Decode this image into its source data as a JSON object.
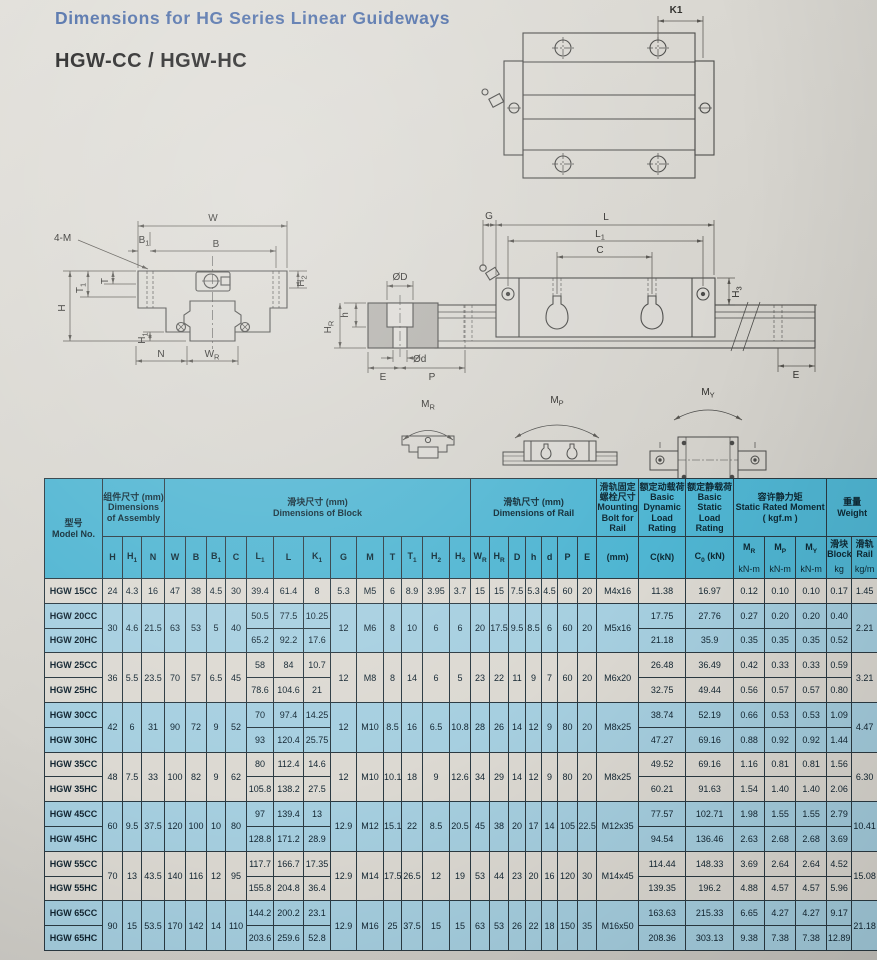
{
  "page": {
    "title": "Dimensions for HG Series Linear Guideways",
    "subtitle": "HGW-CC / HGW-HC"
  },
  "drawings": {
    "k1": "K1",
    "w": "W",
    "b1": "B~1~",
    "b": "B",
    "four_m": "4-M",
    "t": "T",
    "t1": "T~1~",
    "h": "H",
    "h2": "H~2~",
    "h1": "H~1~",
    "n": "N",
    "wr": "W~R~",
    "g": "G",
    "l": "L",
    "l1": "L~1~",
    "c": "C",
    "h3": "H~3~",
    "od": "ØD",
    "od_small": "Ød",
    "e_left": "E",
    "p": "P",
    "e_right": "E",
    "hr": "H~R~",
    "h_small": "h",
    "mr": "M~R~",
    "mp": "M~P~",
    "my": "M~Y~"
  },
  "table": {
    "header": {
      "model": {
        "zh": "型号",
        "en": "Model No."
      },
      "groups": [
        {
          "zh": "组件尺寸 (mm)",
          "en": "Dimensions of Assembly",
          "span": 3
        },
        {
          "zh": "滑块尺寸 (mm)",
          "en": "Dimensions of Block",
          "span": 13
        },
        {
          "zh": "滑轨尺寸 (mm)",
          "en": "Dimensions of Rail",
          "span": 7
        },
        {
          "zh": "滑轨固定螺栓尺寸",
          "en": "Mounting Bolt for Rail",
          "span": 1
        },
        {
          "zh": "额定动载荷",
          "en": "Basic Dynamic Load Rating",
          "span": 1
        },
        {
          "zh": "额定静载荷",
          "en": "Basic Static Load Rating",
          "span": 1
        },
        {
          "zh": "容许静力矩",
          "en": "Static Rated Moment ( kgf.m )",
          "span": 3
        },
        {
          "zh": "重量",
          "en": "Weight",
          "span": 2
        }
      ],
      "columns": [
        {
          "key": "H",
          "label": "H"
        },
        {
          "key": "H1",
          "label": "H~1~"
        },
        {
          "key": "N",
          "label": "N"
        },
        {
          "key": "W",
          "label": "W"
        },
        {
          "key": "B",
          "label": "B"
        },
        {
          "key": "B1",
          "label": "B~1~"
        },
        {
          "key": "C",
          "label": "C"
        },
        {
          "key": "L1",
          "label": "L~1~"
        },
        {
          "key": "L",
          "label": "L"
        },
        {
          "key": "K1",
          "label": "K~1~"
        },
        {
          "key": "G",
          "label": "G"
        },
        {
          "key": "M",
          "label": "M"
        },
        {
          "key": "T",
          "label": "T"
        },
        {
          "key": "T1",
          "label": "T~1~"
        },
        {
          "key": "H2",
          "label": "H~2~"
        },
        {
          "key": "H3",
          "label": "H~3~"
        },
        {
          "key": "WR",
          "label": "W~R~"
        },
        {
          "key": "HR",
          "label": "H~R~"
        },
        {
          "key": "D",
          "label": "D"
        },
        {
          "key": "h",
          "label": "h"
        },
        {
          "key": "d",
          "label": "d"
        },
        {
          "key": "P",
          "label": "P"
        },
        {
          "key": "E",
          "label": "E"
        },
        {
          "key": "bolt",
          "label": "(mm)"
        },
        {
          "key": "Cdyn",
          "label": "C(kN)"
        },
        {
          "key": "C0",
          "label": "C~0~ (kN)"
        },
        {
          "key": "MR",
          "label": "M~R~",
          "unit": "kN-m"
        },
        {
          "key": "MP",
          "label": "M~P~",
          "unit": "kN-m"
        },
        {
          "key": "MY",
          "label": "M~Y~",
          "unit": "kN-m"
        },
        {
          "key": "wblk",
          "label": "滑块 Block",
          "unit": "kg"
        },
        {
          "key": "wrail",
          "label": "滑轨 Rail",
          "unit": "kg/m"
        }
      ]
    },
    "groups": [
      {
        "tone": "light",
        "models": [
          "HGW 15CC"
        ],
        "shared": {
          "H": "24",
          "H1": "4.3",
          "N": "16",
          "W": "47",
          "B": "38",
          "B1": "4.5",
          "C": "30",
          "G": "5.3",
          "M": "M5",
          "T": "6",
          "T1": "8.9",
          "H2": "3.95",
          "H3": "3.7",
          "WR": "15",
          "HR": "15",
          "D": "7.5",
          "h": "5.3",
          "d": "4.5",
          "P": "60",
          "E": "20",
          "bolt": "M4x16",
          "wrail": "1.45"
        },
        "per": [
          {
            "L1": "39.4",
            "L": "61.4",
            "K1": "8",
            "Cdyn": "11.38",
            "C0": "16.97",
            "MR": "0.12",
            "MP": "0.10",
            "MY": "0.10",
            "wblk": "0.17"
          }
        ]
      },
      {
        "tone": "blue",
        "models": [
          "HGW 20CC",
          "HGW 20HC"
        ],
        "shared": {
          "H": "30",
          "H1": "4.6",
          "N": "21.5",
          "W": "63",
          "B": "53",
          "B1": "5",
          "C": "40",
          "G": "12",
          "M": "M6",
          "T": "8",
          "T1": "10",
          "H2": "6",
          "H3": "6",
          "WR": "20",
          "HR": "17.5",
          "D": "9.5",
          "h": "8.5",
          "d": "6",
          "P": "60",
          "E": "20",
          "bolt": "M5x16",
          "wrail": "2.21"
        },
        "per": [
          {
            "L1": "50.5",
            "L": "77.5",
            "K1": "10.25",
            "Cdyn": "17.75",
            "C0": "27.76",
            "MR": "0.27",
            "MP": "0.20",
            "MY": "0.20",
            "wblk": "0.40"
          },
          {
            "L1": "65.2",
            "L": "92.2",
            "K1": "17.6",
            "Cdyn": "21.18",
            "C0": "35.9",
            "MR": "0.35",
            "MP": "0.35",
            "MY": "0.35",
            "wblk": "0.52"
          }
        ]
      },
      {
        "tone": "light",
        "models": [
          "HGW 25CC",
          "HGW 25HC"
        ],
        "shared": {
          "H": "36",
          "H1": "5.5",
          "N": "23.5",
          "W": "70",
          "B": "57",
          "B1": "6.5",
          "C": "45",
          "G": "12",
          "M": "M8",
          "T": "8",
          "T1": "14",
          "H2": "6",
          "H3": "5",
          "WR": "23",
          "HR": "22",
          "D": "11",
          "h": "9",
          "d": "7",
          "P": "60",
          "E": "20",
          "bolt": "M6x20",
          "wrail": "3.21"
        },
        "per": [
          {
            "L1": "58",
            "L": "84",
            "K1": "10.7",
            "Cdyn": "26.48",
            "C0": "36.49",
            "MR": "0.42",
            "MP": "0.33",
            "MY": "0.33",
            "wblk": "0.59"
          },
          {
            "L1": "78.6",
            "L": "104.6",
            "K1": "21",
            "Cdyn": "32.75",
            "C0": "49.44",
            "MR": "0.56",
            "MP": "0.57",
            "MY": "0.57",
            "wblk": "0.80"
          }
        ]
      },
      {
        "tone": "blue",
        "models": [
          "HGW 30CC",
          "HGW 30HC"
        ],
        "shared": {
          "H": "42",
          "H1": "6",
          "N": "31",
          "W": "90",
          "B": "72",
          "B1": "9",
          "C": "52",
          "G": "12",
          "M": "M10",
          "T": "8.5",
          "T1": "16",
          "H2": "6.5",
          "H3": "10.8",
          "WR": "28",
          "HR": "26",
          "D": "14",
          "h": "12",
          "d": "9",
          "P": "80",
          "E": "20",
          "bolt": "M8x25",
          "wrail": "4.47"
        },
        "per": [
          {
            "L1": "70",
            "L": "97.4",
            "K1": "14.25",
            "Cdyn": "38.74",
            "C0": "52.19",
            "MR": "0.66",
            "MP": "0.53",
            "MY": "0.53",
            "wblk": "1.09"
          },
          {
            "L1": "93",
            "L": "120.4",
            "K1": "25.75",
            "Cdyn": "47.27",
            "C0": "69.16",
            "MR": "0.88",
            "MP": "0.92",
            "MY": "0.92",
            "wblk": "1.44"
          }
        ]
      },
      {
        "tone": "light",
        "models": [
          "HGW 35CC",
          "HGW 35HC"
        ],
        "shared": {
          "H": "48",
          "H1": "7.5",
          "N": "33",
          "W": "100",
          "B": "82",
          "B1": "9",
          "C": "62",
          "G": "12",
          "M": "M10",
          "T": "10.1",
          "T1": "18",
          "H2": "9",
          "H3": "12.6",
          "WR": "34",
          "HR": "29",
          "D": "14",
          "h": "12",
          "d": "9",
          "P": "80",
          "E": "20",
          "bolt": "M8x25",
          "wrail": "6.30"
        },
        "per": [
          {
            "L1": "80",
            "L": "112.4",
            "K1": "14.6",
            "Cdyn": "49.52",
            "C0": "69.16",
            "MR": "1.16",
            "MP": "0.81",
            "MY": "0.81",
            "wblk": "1.56"
          },
          {
            "L1": "105.8",
            "L": "138.2",
            "K1": "27.5",
            "Cdyn": "60.21",
            "C0": "91.63",
            "MR": "1.54",
            "MP": "1.40",
            "MY": "1.40",
            "wblk": "2.06"
          }
        ]
      },
      {
        "tone": "blue",
        "models": [
          "HGW 45CC",
          "HGW 45HC"
        ],
        "shared": {
          "H": "60",
          "H1": "9.5",
          "N": "37.5",
          "W": "120",
          "B": "100",
          "B1": "10",
          "C": "80",
          "G": "12.9",
          "M": "M12",
          "T": "15.1",
          "T1": "22",
          "H2": "8.5",
          "H3": "20.5",
          "WR": "45",
          "HR": "38",
          "D": "20",
          "h": "17",
          "d": "14",
          "P": "105",
          "E": "22.5",
          "bolt": "M12x35",
          "wrail": "10.41"
        },
        "per": [
          {
            "L1": "97",
            "L": "139.4",
            "K1": "13",
            "Cdyn": "77.57",
            "C0": "102.71",
            "MR": "1.98",
            "MP": "1.55",
            "MY": "1.55",
            "wblk": "2.79"
          },
          {
            "L1": "128.8",
            "L": "171.2",
            "K1": "28.9",
            "Cdyn": "94.54",
            "C0": "136.46",
            "MR": "2.63",
            "MP": "2.68",
            "MY": "2.68",
            "wblk": "3.69"
          }
        ]
      },
      {
        "tone": "light",
        "models": [
          "HGW 55CC",
          "HGW 55HC"
        ],
        "shared": {
          "H": "70",
          "H1": "13",
          "N": "43.5",
          "W": "140",
          "B": "116",
          "B1": "12",
          "C": "95",
          "G": "12.9",
          "M": "M14",
          "T": "17.5",
          "T1": "26.5",
          "H2": "12",
          "H3": "19",
          "WR": "53",
          "HR": "44",
          "D": "23",
          "h": "20",
          "d": "16",
          "P": "120",
          "E": "30",
          "bolt": "M14x45",
          "wrail": "15.08"
        },
        "per": [
          {
            "L1": "117.7",
            "L": "166.7",
            "K1": "17.35",
            "Cdyn": "114.44",
            "C0": "148.33",
            "MR": "3.69",
            "MP": "2.64",
            "MY": "2.64",
            "wblk": "4.52"
          },
          {
            "L1": "155.8",
            "L": "204.8",
            "K1": "36.4",
            "Cdyn": "139.35",
            "C0": "196.2",
            "MR": "4.88",
            "MP": "4.57",
            "MY": "4.57",
            "wblk": "5.96"
          }
        ]
      },
      {
        "tone": "blue",
        "models": [
          "HGW 65CC",
          "HGW 65HC"
        ],
        "shared": {
          "H": "90",
          "H1": "15",
          "N": "53.5",
          "W": "170",
          "B": "142",
          "B1": "14",
          "C": "110",
          "G": "12.9",
          "M": "M16",
          "T": "25",
          "T1": "37.5",
          "H2": "15",
          "H3": "15",
          "WR": "63",
          "HR": "53",
          "D": "26",
          "h": "22",
          "d": "18",
          "P": "150",
          "E": "35",
          "bolt": "M16x50",
          "wrail": "21.18"
        },
        "per": [
          {
            "L1": "144.2",
            "L": "200.2",
            "K1": "23.1",
            "Cdyn": "163.63",
            "C0": "215.33",
            "MR": "6.65",
            "MP": "4.27",
            "MY": "4.27",
            "wblk": "9.17"
          },
          {
            "L1": "203.6",
            "L": "259.6",
            "K1": "52.8",
            "Cdyn": "208.36",
            "C0": "303.13",
            "MR": "9.38",
            "MP": "7.38",
            "MY": "7.38",
            "wblk": "12.89"
          }
        ]
      }
    ]
  }
}
